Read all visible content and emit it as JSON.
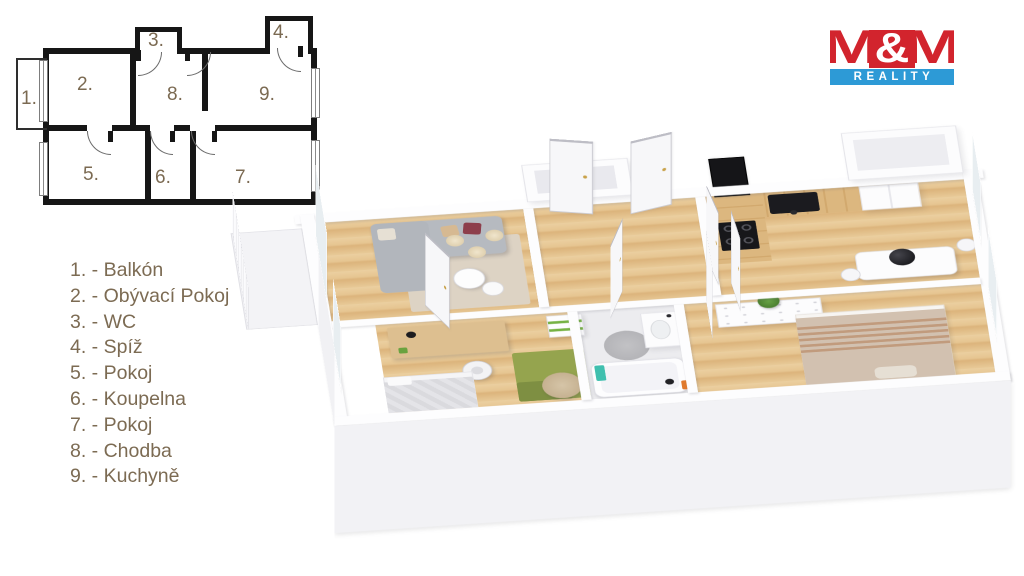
{
  "logo": {
    "m1": "M",
    "amp": "&",
    "m2": "M",
    "reality": "REALITY",
    "brand_red": "#d2242d",
    "brand_blue": "#2d9ad6"
  },
  "plan2d": {
    "labels": {
      "r1": "1.",
      "r2": "2.",
      "r3": "3.",
      "r4": "4.",
      "r5": "5.",
      "r6": "6.",
      "r7": "7.",
      "r8": "8.",
      "r9": "9."
    }
  },
  "legend": {
    "items": [
      "1. - Balkón",
      "2. - Obývací Pokoj",
      "3. - WC",
      "4. - Spíž",
      "5. - Pokoj",
      "6. - Koupelna",
      "7. - Pokoj",
      "8. - Chodba",
      "9. - Kuchyně"
    ]
  },
  "colors": {
    "plan_walls": "#161616",
    "label_text": "#7c6b53",
    "wood_floor": "#e3c28e",
    "wall_white": "#fdfdfe",
    "tile_gray": "#ececef",
    "sofa_gray": "#b6bac0",
    "rug_beige": "#ddd3c4",
    "rug_green": "#95a44e",
    "pillow_burgundy": "#8d3e4b",
    "pillow_beige": "#d6b992",
    "counter_wood": "#d9b078",
    "appliance_black": "#17171a",
    "bed_beige": "#d2c1b0",
    "towel_teal": "#3fbfae",
    "plant_green": "#5c9040"
  }
}
